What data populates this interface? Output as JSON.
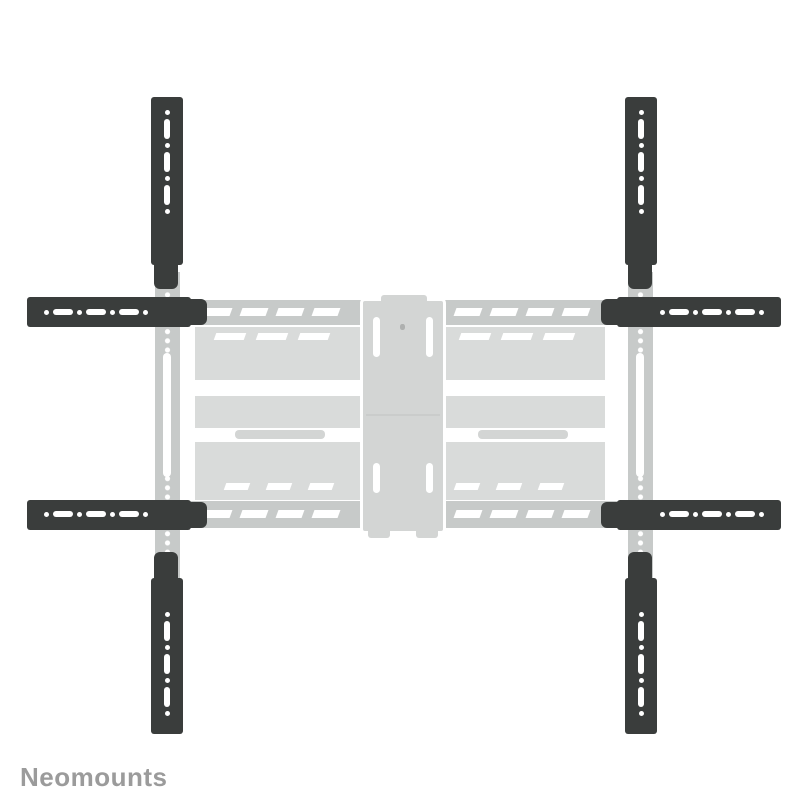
{
  "brand": {
    "name": "Neomounts"
  },
  "product_render": {
    "label": "tv-wall-mount-with-vesa-extension-arms",
    "extension_arm_count": 8
  },
  "colors": {
    "background": "#ffffff",
    "arm_black": "#3a3d3c",
    "rail_gray": "#c7cac9",
    "plate_gray": "#d3d5d4",
    "mount_light_gray": "#d9dbda",
    "logo_gray": "#9b9b9b"
  }
}
